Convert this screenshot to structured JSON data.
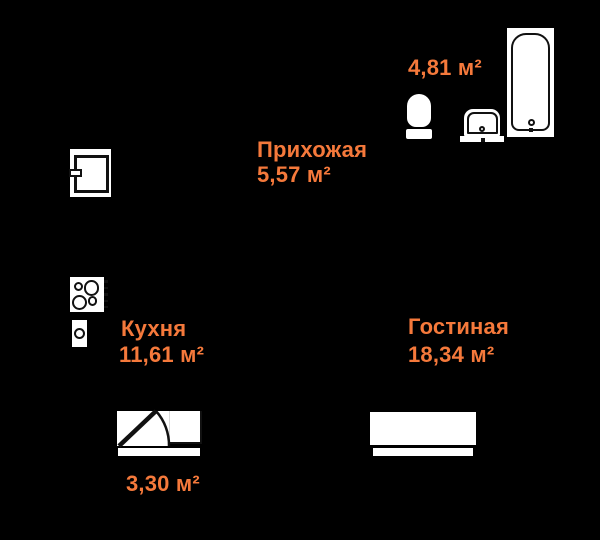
{
  "canvas": {
    "background_color": "#000000",
    "accent_color": "#F5793B",
    "fixture_fill": "#FFFFFF",
    "outline_color": "#111111"
  },
  "rooms": {
    "hallway": {
      "name": "Прихожая",
      "area": "5,57 м²"
    },
    "bathroom": {
      "area": "4,81 м²"
    },
    "kitchen": {
      "name": "Кухня",
      "area": "11,61 м²"
    },
    "living": {
      "name": "Гостиная",
      "area": "18,34 м²"
    },
    "balcony": {
      "area": "3,30 м²"
    }
  },
  "icons": [
    "fridge-icon",
    "stove-icon",
    "kitchen-sink-icon",
    "balcony-door-icon",
    "sofa-icon",
    "toilet-icon",
    "washbasin-icon",
    "bathtub-icon"
  ]
}
